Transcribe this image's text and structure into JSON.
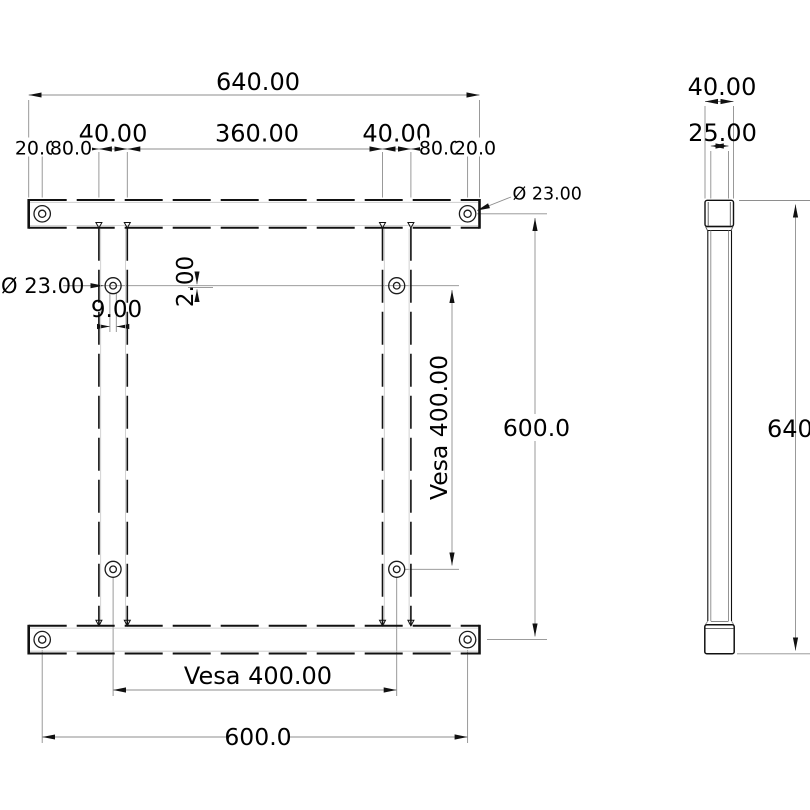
{
  "front": {
    "total_width": "640.00",
    "leg_width_left": "40.00",
    "span_inner": "360.00",
    "leg_width_right": "40.00",
    "edge_left": "20.0",
    "offset_left": "80.0",
    "offset_right": "80.0",
    "edge_right": "20.0",
    "hole_dia_corner": "Ø 23.00",
    "hole_dia_left": "Ø 23.00",
    "leg_hole_dia": "9.00",
    "thickness": "2.00",
    "vesa_vertical": "Vesa 400.00",
    "holes_height": "600.0",
    "vesa_horizontal": "Vesa 400.00",
    "holes_width": "600.0"
  },
  "side": {
    "depth": "40.00",
    "leg_depth": "25.00",
    "total_height": "640.0"
  },
  "colors": {
    "line": "#111111",
    "dim": "#8e8e8e",
    "text": "#000000",
    "background": "#ffffff"
  }
}
